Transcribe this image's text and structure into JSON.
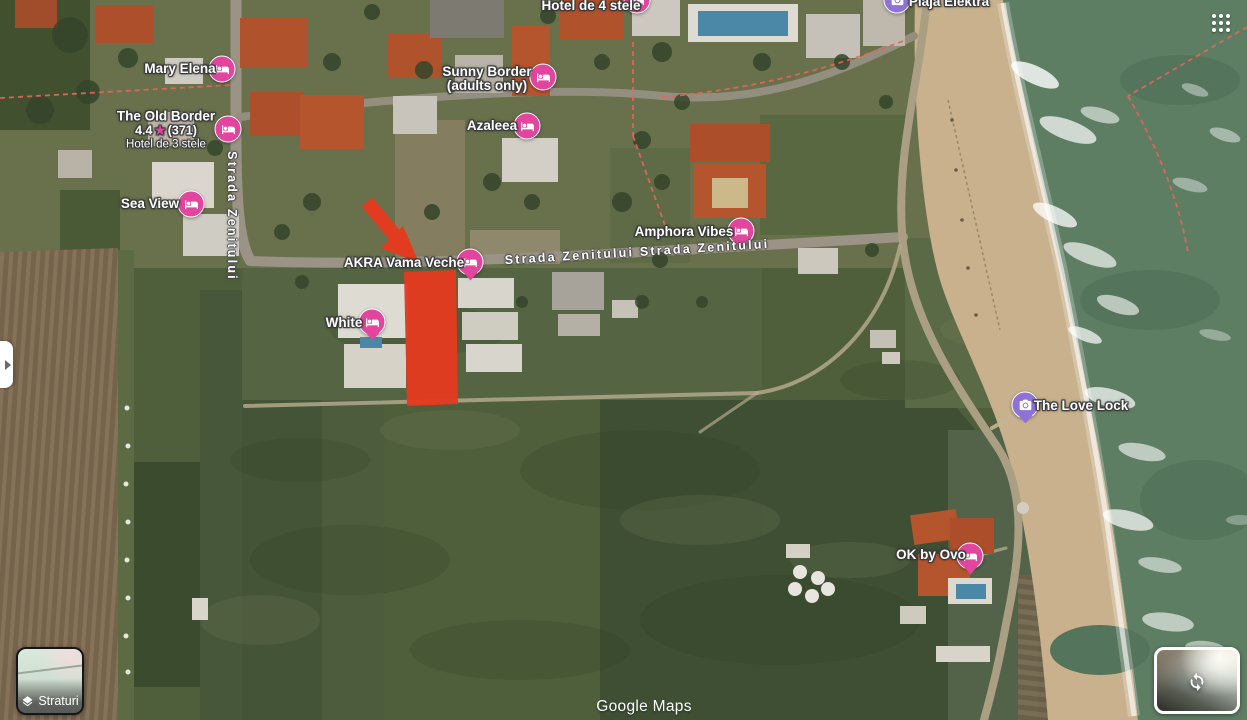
{
  "map": {
    "attribution": "Google Maps",
    "colors": {
      "pink": "#E2459D",
      "purple": "#8F72D8",
      "red": "#E23B20"
    },
    "places": [
      {
        "name": "Mary Elena",
        "marker": {
          "type": "lodging",
          "icon": "bed",
          "x": 222,
          "y": 69,
          "tail": false
        },
        "label": {
          "x": 180,
          "y": 69
        }
      },
      {
        "name": "The Old Border",
        "rating": "4.4",
        "reviews": "(371)",
        "subtitle": "Hotel de 3 stele",
        "marker": {
          "type": "lodging",
          "icon": "bed",
          "x": 228,
          "y": 129,
          "tail": false
        },
        "label": {
          "x": 166,
          "y": 130
        }
      },
      {
        "name": "Sunny Border",
        "lines": [
          "Sunny Border",
          "(adults only)"
        ],
        "marker": {
          "type": "lodging",
          "icon": "bed",
          "x": 543,
          "y": 77,
          "tail": false
        },
        "label": {
          "x": 487,
          "y": 79
        }
      },
      {
        "name": "Azaleea",
        "marker": {
          "type": "lodging",
          "icon": "bed",
          "x": 527,
          "y": 126,
          "tail": false
        },
        "label": {
          "x": 492,
          "y": 126
        }
      },
      {
        "name": "Sea View",
        "marker": {
          "type": "lodging",
          "icon": "bed",
          "x": 191,
          "y": 204,
          "tail": false
        },
        "label": {
          "x": 150,
          "y": 204
        }
      },
      {
        "name": "Hotel de 4 stele",
        "marker": {
          "type": "lodging",
          "icon": "bed",
          "x": 637,
          "y": 0,
          "tail": false
        },
        "label": {
          "x": 591,
          "y": 6
        }
      },
      {
        "name": "AKRA Vama Veche",
        "marker": {
          "type": "lodging",
          "icon": "bed",
          "x": 470,
          "y": 262,
          "tail": true
        },
        "label": {
          "x": 404,
          "y": 263
        }
      },
      {
        "name": "Amphora Vibes",
        "marker": {
          "type": "lodging",
          "icon": "bed",
          "x": 741,
          "y": 231,
          "tail": true
        },
        "label": {
          "x": 684,
          "y": 232
        }
      },
      {
        "name": "White",
        "marker": {
          "type": "lodging",
          "icon": "bed",
          "x": 372,
          "y": 322,
          "tail": true
        },
        "label": {
          "x": 344,
          "y": 323
        }
      },
      {
        "name": "The Love Lock",
        "marker": {
          "type": "attraction",
          "icon": "camera",
          "x": 1025,
          "y": 405,
          "tail": true
        },
        "label": {
          "x": 1081,
          "y": 406
        }
      },
      {
        "name": "OK by Ovo",
        "marker": {
          "type": "lodging",
          "icon": "bed",
          "x": 970,
          "y": 556,
          "tail": true
        },
        "label": {
          "x": 931,
          "y": 555
        }
      },
      {
        "name": "Plaja Elektra",
        "marker": {
          "type": "attraction",
          "icon": "camera",
          "x": 897,
          "y": 0,
          "tail": false
        },
        "label": {
          "x": 949,
          "y": 2
        }
      }
    ],
    "road_labels": [
      {
        "text": "Strada Zenitului",
        "x": 232,
        "y": 216,
        "rotate": 90
      },
      {
        "text": "Strada Zenitului Strada Zenitului",
        "x": 637,
        "y": 252,
        "rotate": -3.5
      }
    ]
  },
  "controls": {
    "layers": {
      "label": "Straturi"
    }
  }
}
